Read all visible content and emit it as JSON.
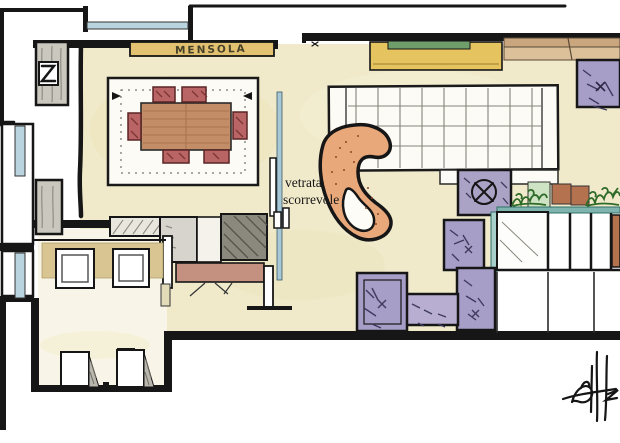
{
  "labels": {
    "shelf": "MENSOLA",
    "glass_partition_line1": "vetrata",
    "glass_partition_line2": "scorrevole"
  },
  "palette": {
    "paper": "#ffffff",
    "ink": "#161616",
    "floor_cream": "#f0eacb",
    "floor_light": "#f8f5e8",
    "window_glass": "#b9d3df",
    "sliding_glass": "#a9c8d6",
    "shelf_wood": "#e2c271",
    "cabinet_yellow": "#e5c35e",
    "accent_green": "#6f9e6a",
    "counter_tan_dark": "#c9a67e",
    "counter_tan_light": "#dcc09a",
    "table_wood": "#c38d68",
    "chair_red": "#b96565",
    "rug_white": "#fcfbf5",
    "chaise_orange": "#e8a87a",
    "sofa_purple": "#a79ec8",
    "sofa_purple_light": "#b7aed2",
    "plant_green": "#2f6b28",
    "counter_teal": "#7fb5ae",
    "tile_terracotta": "#b5724f",
    "cushion_gray": "#d6d4cc",
    "cushion_dark": "#8b897e",
    "sofa_back_rose": "#c49080",
    "sideboard_tan": "#d9c592",
    "column_gray": "#c9c7be"
  }
}
